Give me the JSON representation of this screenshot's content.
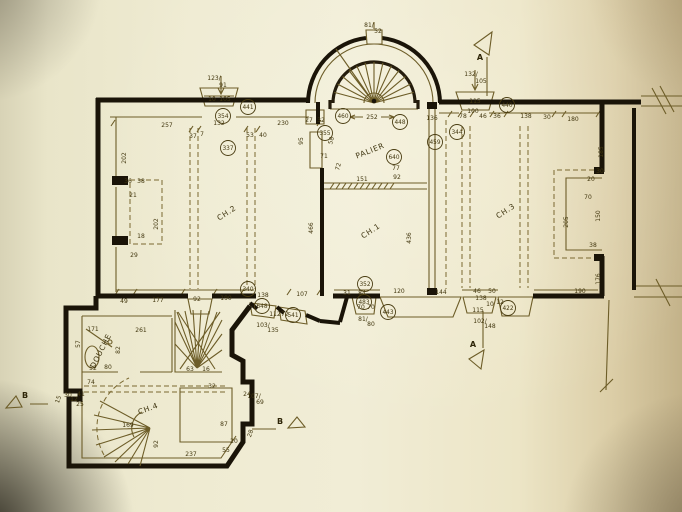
{
  "drawing": {
    "type": "architectural-floor-plan",
    "colors": {
      "paper": "#f0ecd4",
      "ink_walls": "#1a1408",
      "ink_lines": "#6d5d28",
      "ink_text": "#42370f"
    },
    "rooms": [
      {
        "label": "CH.2",
        "x": 228,
        "y": 215,
        "r": -33,
        "s": 7.5
      },
      {
        "label": "CH.1",
        "x": 372,
        "y": 233,
        "r": -33,
        "s": 7.5
      },
      {
        "label": "CH.3",
        "x": 507,
        "y": 213,
        "r": -33,
        "s": 7.5
      },
      {
        "label": "CH.4",
        "x": 149,
        "y": 411,
        "r": -20,
        "s": 7.5
      },
      {
        "label": "PALIER",
        "x": 371,
        "y": 153,
        "r": -22,
        "s": 7
      },
      {
        "label": "DOUCHE",
        "x": 103,
        "y": 352,
        "r": -63,
        "s": 5.5
      }
    ],
    "circles": [
      {
        "t": "337",
        "x": 228,
        "y": 148
      },
      {
        "t": "354",
        "x": 223,
        "y": 116
      },
      {
        "t": "441",
        "x": 248,
        "y": 107
      },
      {
        "t": "355",
        "x": 325,
        "y": 133
      },
      {
        "t": "460",
        "x": 343,
        "y": 116
      },
      {
        "t": "448",
        "x": 400,
        "y": 122
      },
      {
        "t": "640",
        "x": 394,
        "y": 157
      },
      {
        "t": "459",
        "x": 435,
        "y": 142
      },
      {
        "t": "344",
        "x": 457,
        "y": 132
      },
      {
        "t": "440",
        "x": 507,
        "y": 105
      },
      {
        "t": "340",
        "x": 248,
        "y": 289
      },
      {
        "t": "648",
        "x": 262,
        "y": 306
      },
      {
        "t": "541",
        "x": 293,
        "y": 315
      },
      {
        "t": "352",
        "x": 365,
        "y": 284
      },
      {
        "t": "483",
        "x": 364,
        "y": 302
      },
      {
        "t": "443",
        "x": 388,
        "y": 312
      },
      {
        "t": "422",
        "x": 508,
        "y": 308
      }
    ],
    "dims": [
      {
        "t": "123/",
        "x": 214,
        "y": 80
      },
      {
        "t": "91",
        "x": 223,
        "y": 87
      },
      {
        "t": "10",
        "x": 212,
        "y": 101
      },
      {
        "t": "105",
        "x": 225,
        "y": 101
      },
      {
        "t": "132",
        "x": 219,
        "y": 125
      },
      {
        "t": "81/",
        "x": 369,
        "y": 27
      },
      {
        "t": "52",
        "x": 378,
        "y": 33
      },
      {
        "t": "252",
        "x": 372,
        "y": 119
      },
      {
        "t": "132/",
        "x": 471,
        "y": 76
      },
      {
        "t": "105",
        "x": 481,
        "y": 83
      },
      {
        "t": "115",
        "x": 475,
        "y": 103
      },
      {
        "t": "100",
        "x": 473,
        "y": 113
      },
      {
        "t": "257",
        "x": 167,
        "y": 127
      },
      {
        "t": "37",
        "x": 193,
        "y": 138
      },
      {
        "t": "7",
        "x": 202,
        "y": 136
      },
      {
        "t": "53",
        "x": 250,
        "y": 137
      },
      {
        "t": "40",
        "x": 263,
        "y": 137
      },
      {
        "t": "230",
        "x": 283,
        "y": 125
      },
      {
        "t": "202",
        "x": 126,
        "y": 158,
        "r": -90
      },
      {
        "t": "36",
        "x": 128,
        "y": 183
      },
      {
        "t": "38",
        "x": 141,
        "y": 183
      },
      {
        "t": "21",
        "x": 133,
        "y": 197
      },
      {
        "t": "202",
        "x": 158,
        "y": 224,
        "r": -90
      },
      {
        "t": "18",
        "x": 141,
        "y": 238
      },
      {
        "t": "29",
        "x": 134,
        "y": 257
      },
      {
        "t": "49",
        "x": 124,
        "y": 303
      },
      {
        "t": "177",
        "x": 158,
        "y": 302
      },
      {
        "t": "92",
        "x": 197,
        "y": 301
      },
      {
        "t": "190",
        "x": 226,
        "y": 300
      },
      {
        "t": "138",
        "x": 263,
        "y": 297
      },
      {
        "t": "107",
        "x": 302,
        "y": 296
      },
      {
        "t": "466",
        "x": 313,
        "y": 228,
        "r": -90
      },
      {
        "t": "27",
        "x": 309,
        "y": 122
      },
      {
        "t": "32",
        "x": 321,
        "y": 122
      },
      {
        "t": "95",
        "x": 303,
        "y": 141,
        "r": -90
      },
      {
        "t": "58",
        "x": 333,
        "y": 141,
        "r": -75
      },
      {
        "t": "71",
        "x": 324,
        "y": 158
      },
      {
        "t": "72",
        "x": 340,
        "y": 167,
        "r": -75
      },
      {
        "t": "151",
        "x": 362,
        "y": 181
      },
      {
        "t": "77",
        "x": 396,
        "y": 170
      },
      {
        "t": "92",
        "x": 397,
        "y": 179
      },
      {
        "t": "136",
        "x": 432,
        "y": 120
      },
      {
        "t": "436",
        "x": 411,
        "y": 238,
        "r": -90
      },
      {
        "t": "78",
        "x": 463,
        "y": 118
      },
      {
        "t": "46",
        "x": 483,
        "y": 118
      },
      {
        "t": "36",
        "x": 497,
        "y": 118
      },
      {
        "t": "138",
        "x": 526,
        "y": 118
      },
      {
        "t": "30",
        "x": 547,
        "y": 119
      },
      {
        "t": "180",
        "x": 573,
        "y": 121
      },
      {
        "t": "185",
        "x": 603,
        "y": 152,
        "r": -90
      },
      {
        "t": "30",
        "x": 600,
        "y": 173
      },
      {
        "t": "20",
        "x": 591,
        "y": 181
      },
      {
        "t": "70",
        "x": 588,
        "y": 199
      },
      {
        "t": "150",
        "x": 600,
        "y": 216,
        "r": -90
      },
      {
        "t": "205",
        "x": 568,
        "y": 222,
        "r": -90
      },
      {
        "t": "38",
        "x": 593,
        "y": 247
      },
      {
        "t": "176",
        "x": 600,
        "y": 279,
        "r": -90
      },
      {
        "t": "190",
        "x": 580,
        "y": 293
      },
      {
        "t": "31",
        "x": 347,
        "y": 295
      },
      {
        "t": "84",
        "x": 362,
        "y": 295
      },
      {
        "t": "120",
        "x": 399,
        "y": 293
      },
      {
        "t": "144",
        "x": 441,
        "y": 294
      },
      {
        "t": "46",
        "x": 477,
        "y": 293
      },
      {
        "t": "50",
        "x": 492,
        "y": 293
      },
      {
        "t": "138",
        "x": 481,
        "y": 300
      },
      {
        "t": "10",
        "x": 490,
        "y": 306
      },
      {
        "t": "115",
        "x": 478,
        "y": 312
      },
      {
        "t": "12",
        "x": 500,
        "y": 304
      },
      {
        "t": "102/",
        "x": 480,
        "y": 323
      },
      {
        "t": "148",
        "x": 490,
        "y": 328
      },
      {
        "t": "70",
        "x": 361,
        "y": 309
      },
      {
        "t": "70",
        "x": 371,
        "y": 309
      },
      {
        "t": "81/",
        "x": 363,
        "y": 321
      },
      {
        "t": "80",
        "x": 371,
        "y": 326
      },
      {
        "t": "112",
        "x": 275,
        "y": 316
      },
      {
        "t": "72",
        "x": 285,
        "y": 316
      },
      {
        "t": "103/",
        "x": 263,
        "y": 327
      },
      {
        "t": "135",
        "x": 273,
        "y": 332
      },
      {
        "t": "171",
        "x": 93,
        "y": 331
      },
      {
        "t": "261",
        "x": 141,
        "y": 332
      },
      {
        "t": "57",
        "x": 80,
        "y": 344,
        "r": -90
      },
      {
        "t": "82",
        "x": 120,
        "y": 350,
        "r": -90
      },
      {
        "t": "52",
        "x": 93,
        "y": 370
      },
      {
        "t": "80",
        "x": 108,
        "y": 369
      },
      {
        "t": "74",
        "x": 91,
        "y": 384
      },
      {
        "t": "63",
        "x": 190,
        "y": 371
      },
      {
        "t": "16",
        "x": 206,
        "y": 371
      },
      {
        "t": "32",
        "x": 212,
        "y": 388
      },
      {
        "t": "169",
        "x": 128,
        "y": 427
      },
      {
        "t": "92",
        "x": 158,
        "y": 444,
        "r": -90
      },
      {
        "t": "237",
        "x": 191,
        "y": 456
      },
      {
        "t": "55",
        "x": 226,
        "y": 452
      },
      {
        "t": "87",
        "x": 224,
        "y": 426
      },
      {
        "t": "24",
        "x": 247,
        "y": 396
      },
      {
        "t": "20",
        "x": 234,
        "y": 443
      },
      {
        "t": "107/",
        "x": 254,
        "y": 398
      },
      {
        "t": "69",
        "x": 260,
        "y": 404
      },
      {
        "t": "15",
        "x": 60,
        "y": 400,
        "r": -70
      },
      {
        "t": "30",
        "x": 68,
        "y": 397
      },
      {
        "t": "12",
        "x": 74,
        "y": 401
      },
      {
        "t": "41",
        "x": 81,
        "y": 396
      },
      {
        "t": "25",
        "x": 80,
        "y": 406
      },
      {
        "t": "28",
        "x": 252,
        "y": 434,
        "r": -70
      }
    ],
    "markers": {
      "a_top": "A",
      "a_bottom": "A",
      "b_left": "B",
      "b_right": "B"
    }
  }
}
